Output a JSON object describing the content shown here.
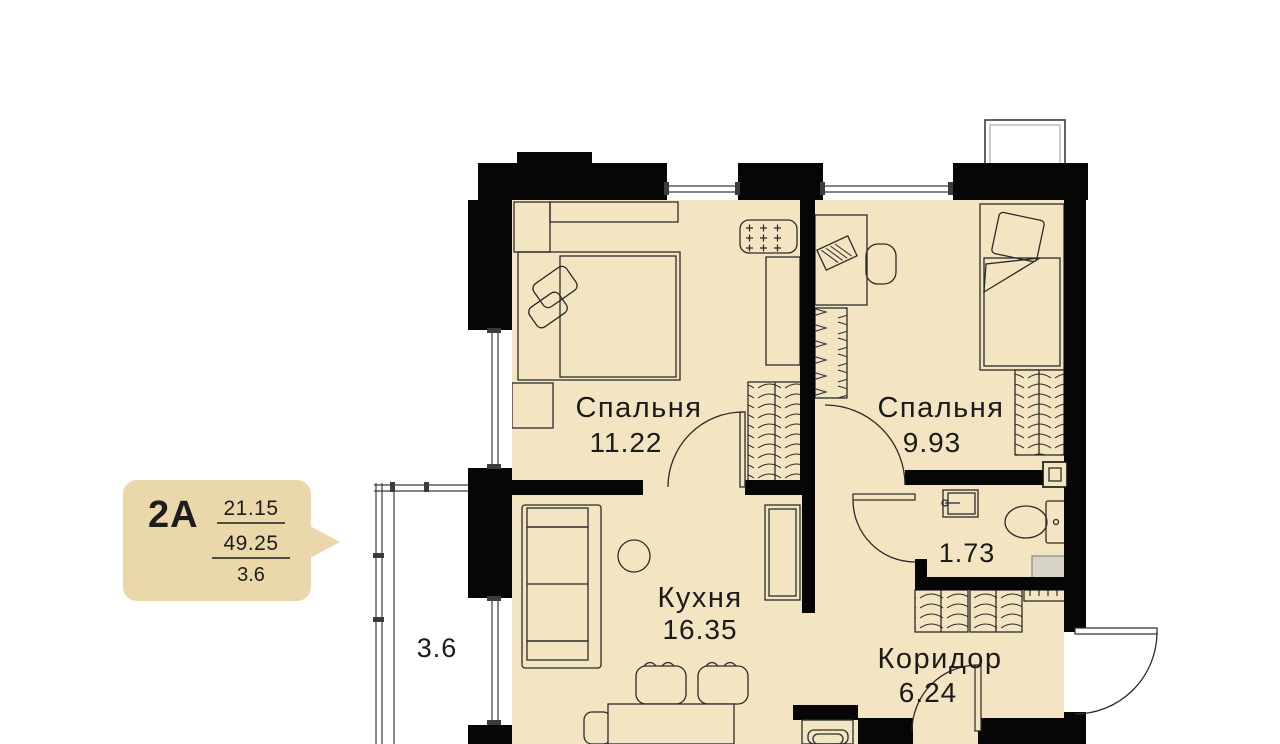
{
  "plan": {
    "badge": {
      "unit": "2А",
      "living_area": "21.15",
      "total_area": "49.25",
      "balcony_area": "3.6"
    },
    "rooms": {
      "bedroom_1": {
        "name": "Спальня",
        "area": "11.22"
      },
      "bedroom_2": {
        "name": "Спальня",
        "area": "9.93"
      },
      "kitchen": {
        "name": "Кухня",
        "area": "16.35"
      },
      "bathroom": {
        "area": "1.73"
      },
      "corridor": {
        "name": "Коридор",
        "area": "6.24"
      },
      "balcony": {
        "area": "3.6"
      }
    },
    "colors": {
      "floor": "#f3e4c2",
      "badge": "#ead8ab",
      "wall": "#060606",
      "background": "#ffffff"
    }
  }
}
